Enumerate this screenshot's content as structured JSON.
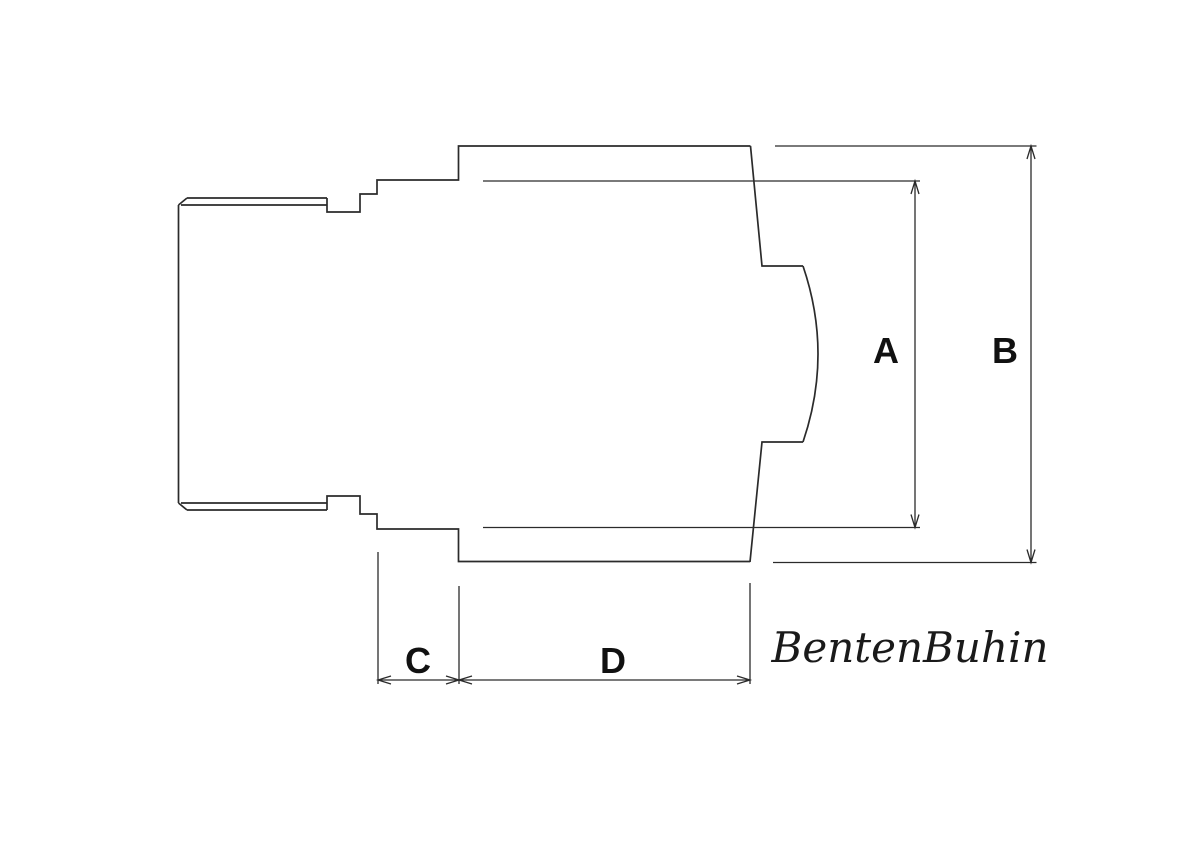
{
  "drawing": {
    "title": "technical drawing of stepped cylindrical fitting with break-out section",
    "labels": {
      "a": "A",
      "b": "B",
      "c": "C",
      "d": "D"
    },
    "signature": "BentenBuhin",
    "colors": {
      "line": "#2b2b2b",
      "label": "#111111",
      "signature": "#1a1a1a",
      "background": "#ffffff"
    }
  }
}
